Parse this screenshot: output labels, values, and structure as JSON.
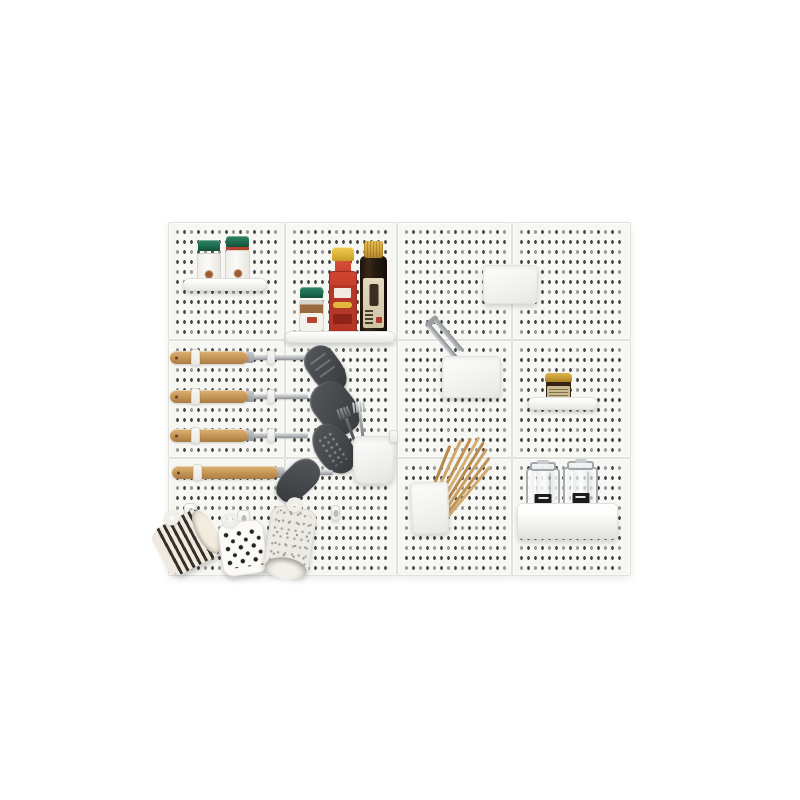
{
  "scene": {
    "type": "product-photo",
    "subject": "White pegboard kitchen wall organizer with shelves, hooks, bins, utensils and cups",
    "background_color": "#ffffff"
  },
  "pegboard": {
    "tiles_cols": 4,
    "tiles_rows": 3,
    "tile_color": "#f6f6f3",
    "hole_color": "#474747",
    "seam_color": "#e1e1dc"
  },
  "palette": {
    "white_plastic": "#f3f3f0",
    "wood_handle": "#c99a58",
    "utensil_head": "#44484b",
    "steel": "#a9adb0",
    "green_cap": "#1c6a4f",
    "chili_red": "#b5372a",
    "cap_yellow": "#ddb238",
    "soy_dark": "#241a10",
    "label_beige": "#d9cfae",
    "gold_lid": "#c59b35",
    "chopstick_wood": "#c49a5e",
    "stripe_black": "#35322d",
    "speckle_gray": "#a8a49c"
  },
  "items": [
    {
      "name": "pegboard",
      "desc": "white perforated pegboard of 12 tiles, 4 columns x 3 rows"
    },
    {
      "name": "spice-shelf",
      "desc": "small white shelf, top left"
    },
    {
      "name": "spice-jar-left",
      "desc": "spice jar with dark green cap and white label",
      "cap_color": "#1c6a4f"
    },
    {
      "name": "spice-jar-right",
      "desc": "spice jar with green cap, red band and white label",
      "cap_color": "#1c6a4f"
    },
    {
      "name": "sauce-shelf",
      "desc": "white shelf holding sauce bottles"
    },
    {
      "name": "small-spice-jar",
      "desc": "glass spice jar with green cap and brown contents"
    },
    {
      "name": "chili-sauce-bottle",
      "desc": "red chili sauce bottle with yellow cap and red label",
      "cap_color": "#ddb238",
      "label_color": "#b5372a"
    },
    {
      "name": "soy-sauce-bottle",
      "desc": "dark soy sauce bottle with gold foil cap and beige label",
      "cap_color": "#cda03a",
      "body_color": "#241a10"
    },
    {
      "name": "white-storage-box",
      "desc": "plain white wall box, upper right"
    },
    {
      "name": "metal-tongs",
      "desc": "stainless tongs leaning out of wall bin"
    },
    {
      "name": "white-wall-bin",
      "desc": "white wall-mounted bin, center"
    },
    {
      "name": "condiment-shelf",
      "desc": "small white shelf, right side"
    },
    {
      "name": "condiment-jar",
      "desc": "small dark jar with gold lid and khaki label",
      "lid_color": "#c59b35"
    },
    {
      "name": "utensil-slotted-turner",
      "desc": "hanging utensil: wood handle, steel shaft, gray slotted turner head"
    },
    {
      "name": "utensil-wide-turner",
      "desc": "hanging utensil: wood handle, steel shaft, wide gray turner head"
    },
    {
      "name": "utensil-skimmer",
      "desc": "hanging utensil: wood handle, steel shaft, perforated gray skimmer head"
    },
    {
      "name": "utensil-spatula",
      "desc": "hanging utensil: wood handle, steel shaft, gray spatula head"
    },
    {
      "name": "fork-cup",
      "desc": "white wall cup holding forks"
    },
    {
      "name": "forks",
      "desc": "two forks standing in cup"
    },
    {
      "name": "chopstick-bin",
      "desc": "white wall bin holding chopsticks"
    },
    {
      "name": "chopsticks",
      "desc": "bundle of wooden chopsticks leaning right"
    },
    {
      "name": "glass-jar-left",
      "desc": "clear glass storage jar with black label"
    },
    {
      "name": "glass-jar-right",
      "desc": "clear glass storage jar with black label"
    },
    {
      "name": "glass-jar-tray",
      "desc": "white tray holding the glass jars"
    },
    {
      "name": "wall-hook-1",
      "desc": "white pegboard hook"
    },
    {
      "name": "wall-hook-2",
      "desc": "white pegboard hook"
    },
    {
      "name": "wall-hook-3",
      "desc": "white pegboard hook"
    },
    {
      "name": "wall-hook-small",
      "desc": "small white pegboard hook"
    },
    {
      "name": "striped-cup",
      "desc": "black and white striped cup hanging at an angle"
    },
    {
      "name": "polka-dot-cup",
      "desc": "white cup with black polka dots"
    },
    {
      "name": "speckled-cup",
      "desc": "speckled gray stoneware cup hanging mouth-down"
    }
  ]
}
